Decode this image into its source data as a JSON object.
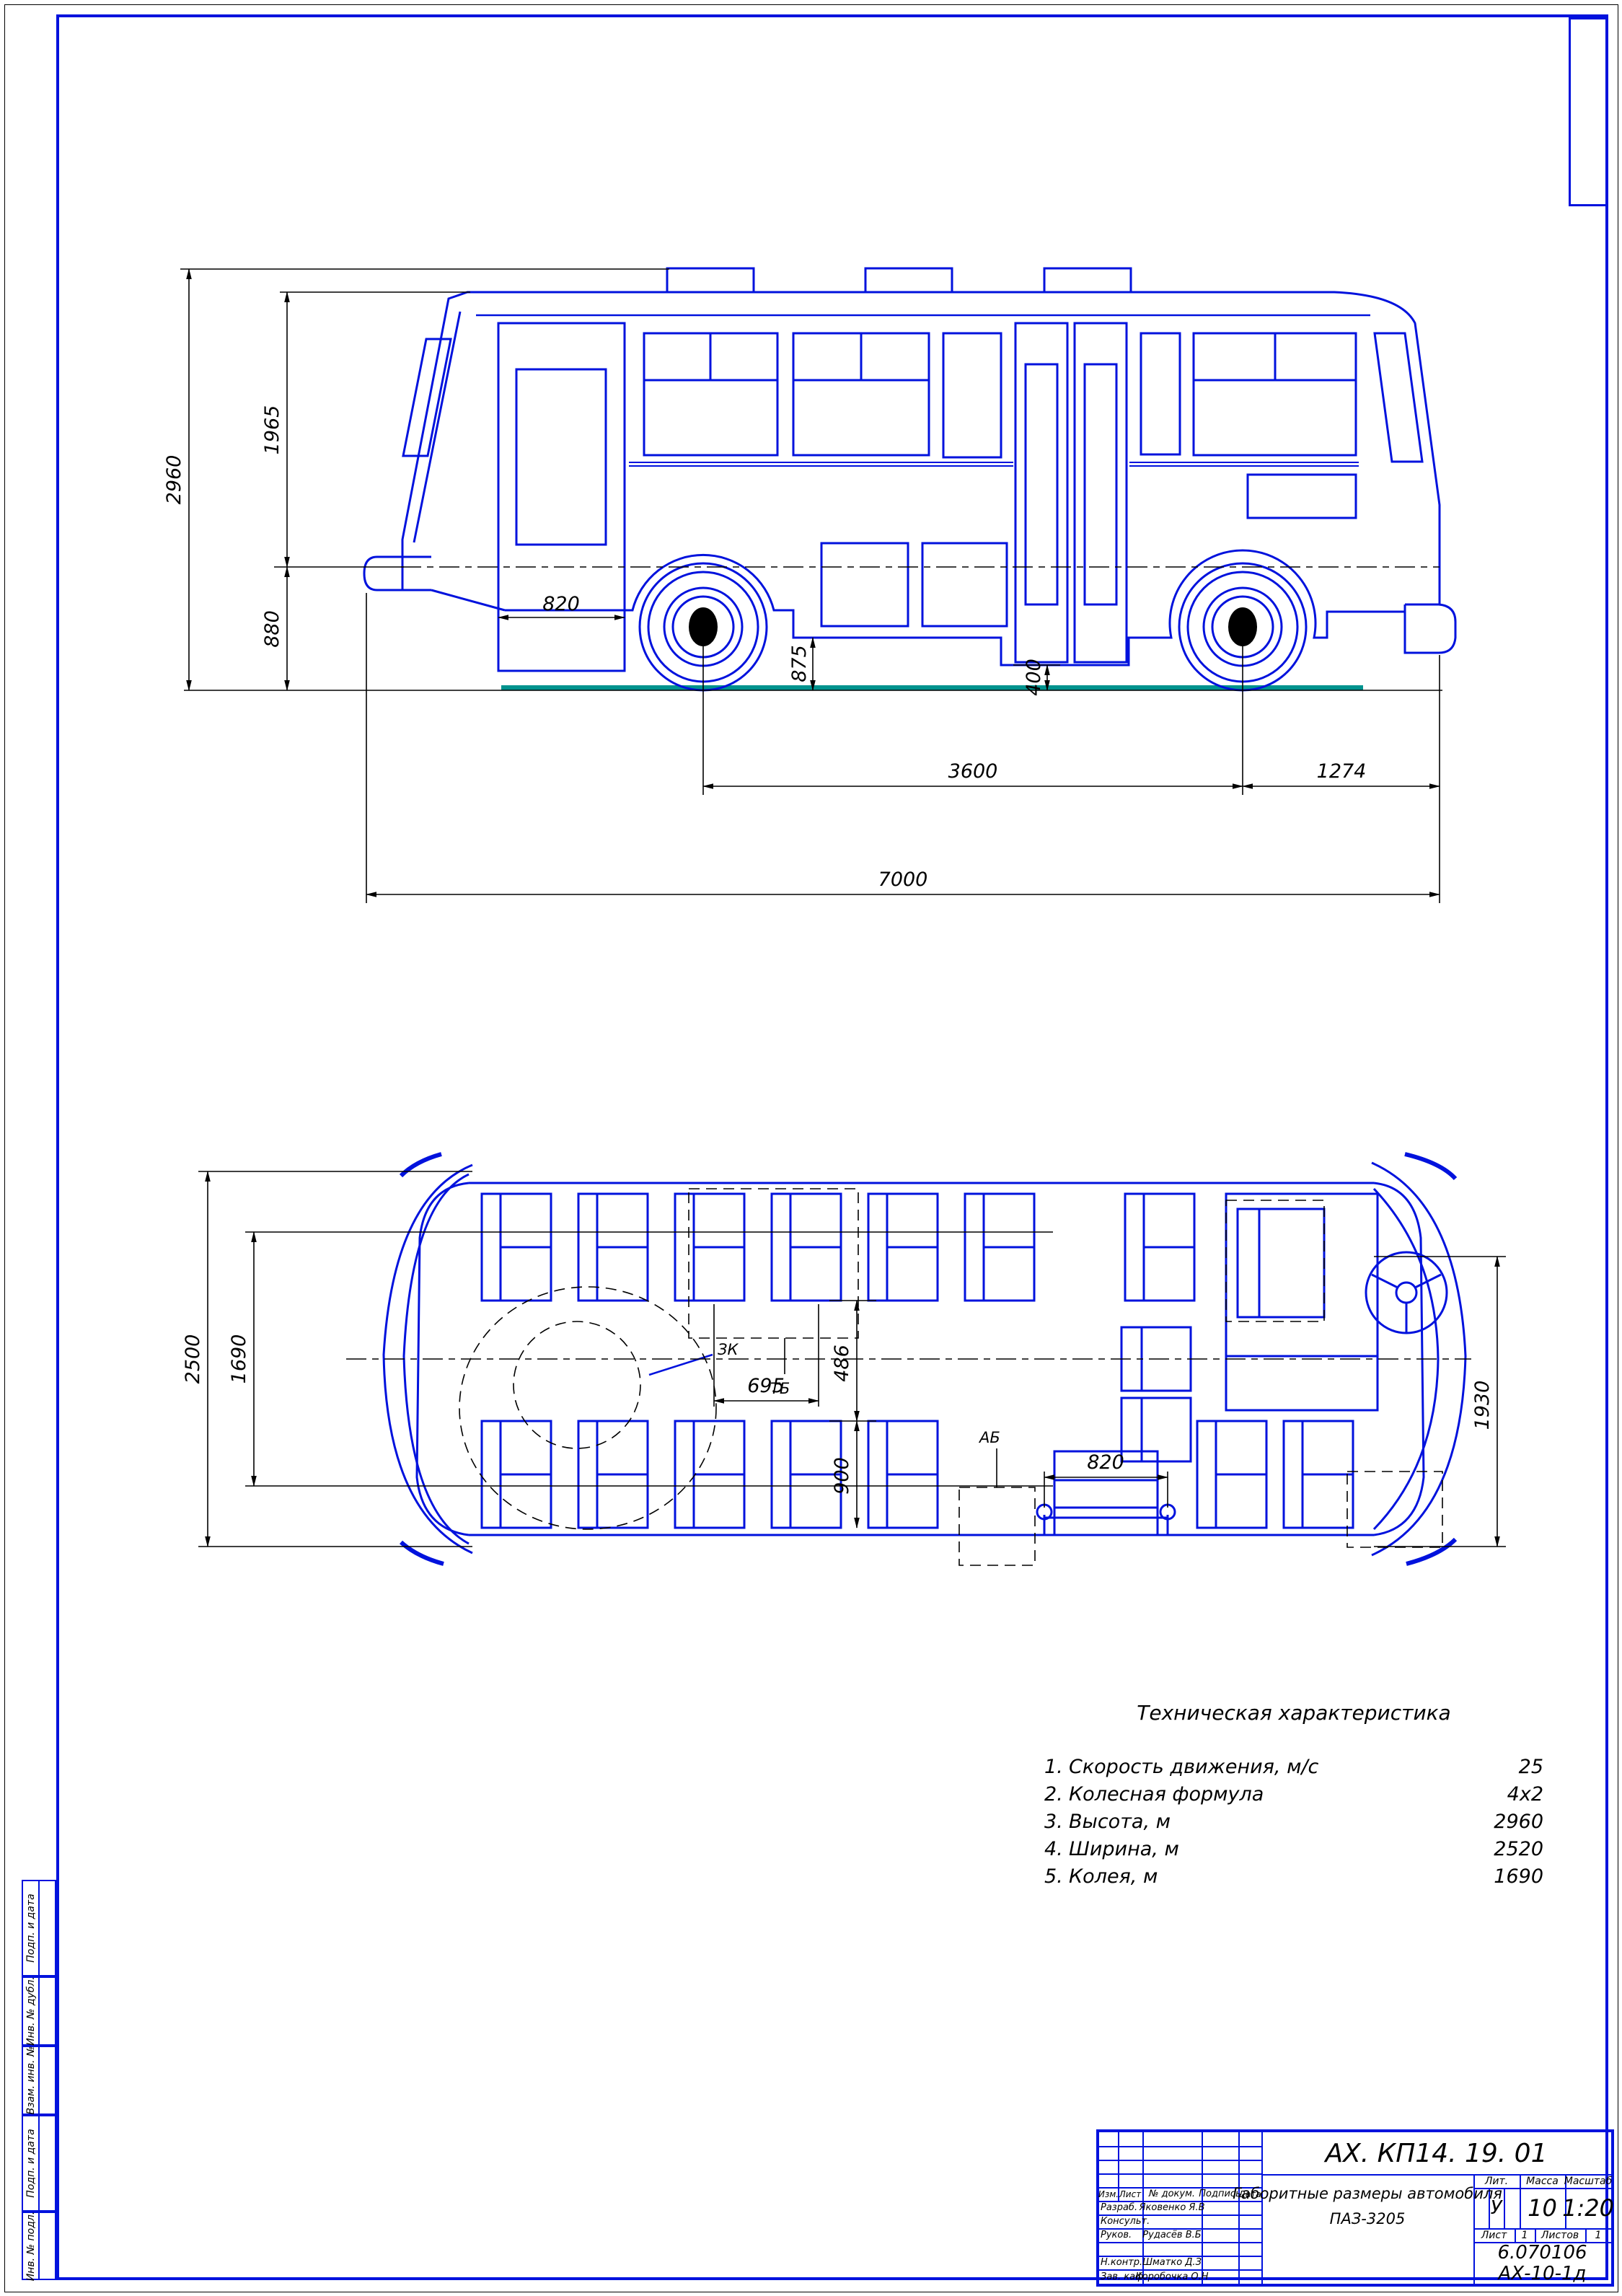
{
  "colors": {
    "line_blue": "#0012dd",
    "ground_teal": "#00938e",
    "black": "#000000"
  },
  "frame": {
    "stamps": [
      "Подп. и дата",
      "Инв. № дубл.",
      "Взам. инв. №",
      "Подп. и дата",
      "Инв. № подл."
    ]
  },
  "side_view": {
    "dims": {
      "height_total": "2960",
      "height_upper": "1965",
      "height_lower": "880",
      "door_width": "820",
      "skirt_height": "875",
      "step_height": "400",
      "wheelbase": "3600",
      "rear_overhang": "1274",
      "length_total": "7000"
    }
  },
  "top_view": {
    "dims": {
      "width_total": "2500",
      "track": "1690",
      "seat_width": "695",
      "aisle_width": "486",
      "seat_row": "900",
      "door_width": "820",
      "front_width": "1930"
    },
    "labels": {
      "spare_wheel": "ЗК",
      "fuel_tank": "ТБ",
      "battery": "АБ"
    }
  },
  "tech": {
    "title": "Техническая характеристика",
    "rows": [
      {
        "num": "1.",
        "label": "Скорость движения,  м/с",
        "value": "25"
      },
      {
        "num": "2.",
        "label": "Колесная формула",
        "value": "4х2"
      },
      {
        "num": "3.",
        "label": "Высота,  м",
        "value": "2960"
      },
      {
        "num": "4.",
        "label": "Ширина,  м",
        "value": "2520"
      },
      {
        "num": "5.",
        "label": "Колея,  м",
        "value": "1690"
      }
    ]
  },
  "title_block": {
    "designation": "АХ. КП14. 19. 01",
    "doc_title_1": "Габоритные размеры автомобиля",
    "doc_title_2": "ПАЗ-3205",
    "cols": {
      "izm": "Изм.",
      "list": "Лист",
      "ndoc": "№ докум.",
      "podpis": "Подпись",
      "data": "Дата"
    },
    "rows": [
      {
        "role": "Разраб.",
        "name": "Яковенко Я.В"
      },
      {
        "role": "Консульт.",
        "name": ""
      },
      {
        "role": "Руков.",
        "name": "Рудасёв В.Б"
      },
      {
        "role": "Н.контр.",
        "name": "Шматко Д.З"
      },
      {
        "role": "Зав. каф.",
        "name": "Коробочка О.Н"
      }
    ],
    "lit_label": "Лит.",
    "lit_value": "У",
    "mass_label": "Масса",
    "mass_value": "10",
    "scale_label": "Масштаб",
    "scale_value": "1:20",
    "sheet_label": "Лист",
    "sheet_value": "1",
    "sheets_label": "Листов",
    "sheets_value": "1",
    "group_line1": "6.070106",
    "group_line2": "АХ-10-1д"
  }
}
